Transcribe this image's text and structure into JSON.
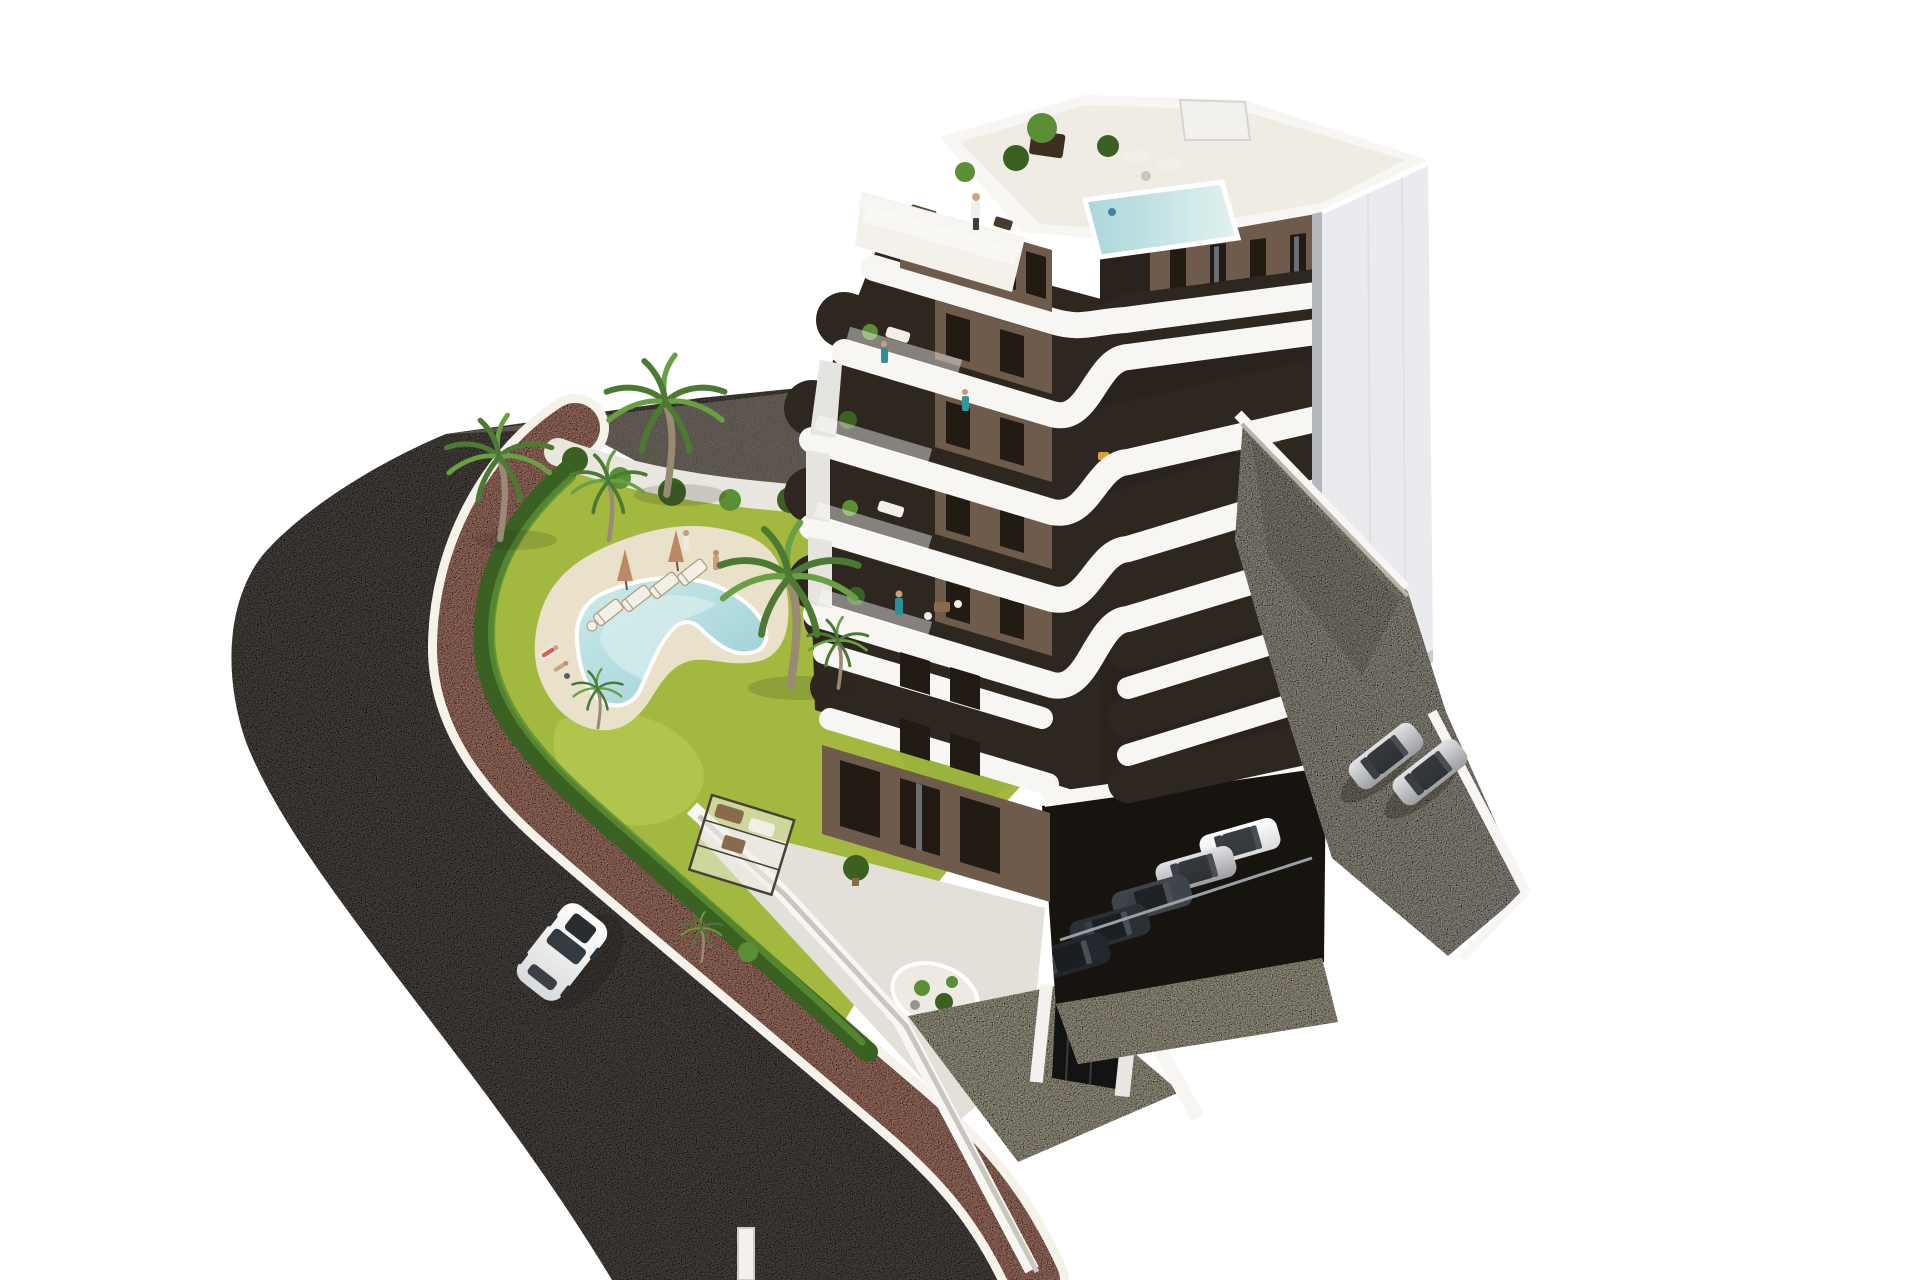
{
  "scene": {
    "description": "Aerial 3D architectural rendering of a modern seven-storey apartment building with white wrap-around balcony bands and brown panels, rooftop terrace with plunge pool, landscaped garden with freeform swimming pool and palm trees, curved asphalt road with pink pedestrian path, surface parking and semi-underground garage with cars",
    "background": "#ffffff"
  },
  "colors": {
    "background": "#ffffff",
    "asphalt": "#6e6861",
    "asphalt_top": "#7b746a",
    "sidewalk": "#e2a28f",
    "sidewalk_border": "#f5f2ec",
    "lawn": "#a3b83e",
    "lawn_light": "#bdcd55",
    "lawn_dark": "#8fae3a",
    "hedge": "#3a6122",
    "hedge_light": "#5b8f35",
    "gravel": "#e9e6df",
    "pool_deck": "#e9e1ca",
    "pool_water": "#a8d8dc",
    "pool_water_light": "#d8eeec",
    "water_roof": "#bfe2e2",
    "building_white": "#f7f6f2",
    "roof_floor": "#efece3",
    "facade_brown": "#6f5b4b",
    "facade_brown_dark": "#55453a",
    "window_dark": "#221b14",
    "recess_dark": "#2e2720",
    "glass_reflect": "#767d82",
    "wing_white": "#e9ebee",
    "concrete": "#cdc8b8",
    "concrete_warm": "#ddd5bc",
    "furniture_cream": "#f2efe6",
    "furniture_wood": "#8a6a4a",
    "car_white": "#f2f3f3",
    "car_silver": "#c6c8ca",
    "car_dark": "#31353c",
    "gate_dark": "#131313",
    "person_teal": "#2e8f96",
    "umbrella_tan": "#b98a63",
    "palm_green": "#4c7a33",
    "palm_green_light": "#6aa044",
    "trunk": "#9a8a74"
  },
  "building": {
    "stories_visible": 7,
    "balcony_bands": 5,
    "rooftop_pool": true,
    "rooftop_plants": 4,
    "facade_style": "white rounded balcony bands, brown wall panels, dark full-height glazing",
    "right_tower": "plain white"
  },
  "garden": {
    "pool_shape": "freeform boomerang",
    "sun_loungers": 4,
    "parasols": 2,
    "palm_trees": 7,
    "hedge_along_path": true,
    "gravel_planting_strip": true
  },
  "vehicles": {
    "street_car": {
      "count": 1,
      "color": "white"
    },
    "surface_parking_cars": {
      "count": 2,
      "color": "silver"
    },
    "garage_cars": {
      "count": 5,
      "colors": [
        "white",
        "silver",
        "dark-gray",
        "dark-gray",
        "black"
      ]
    }
  },
  "people": {
    "count": 10,
    "locations": [
      "rooftop terrace",
      "upper balconies",
      "pool deck",
      "lawn",
      "sunbathing towels"
    ]
  },
  "infrastructure": {
    "road": "curved asphalt",
    "path": "pink paved sidewalk with white kerbs",
    "perimeter_walls": "white",
    "entrance_gate": "black",
    "garage": "semi-underground under building"
  }
}
